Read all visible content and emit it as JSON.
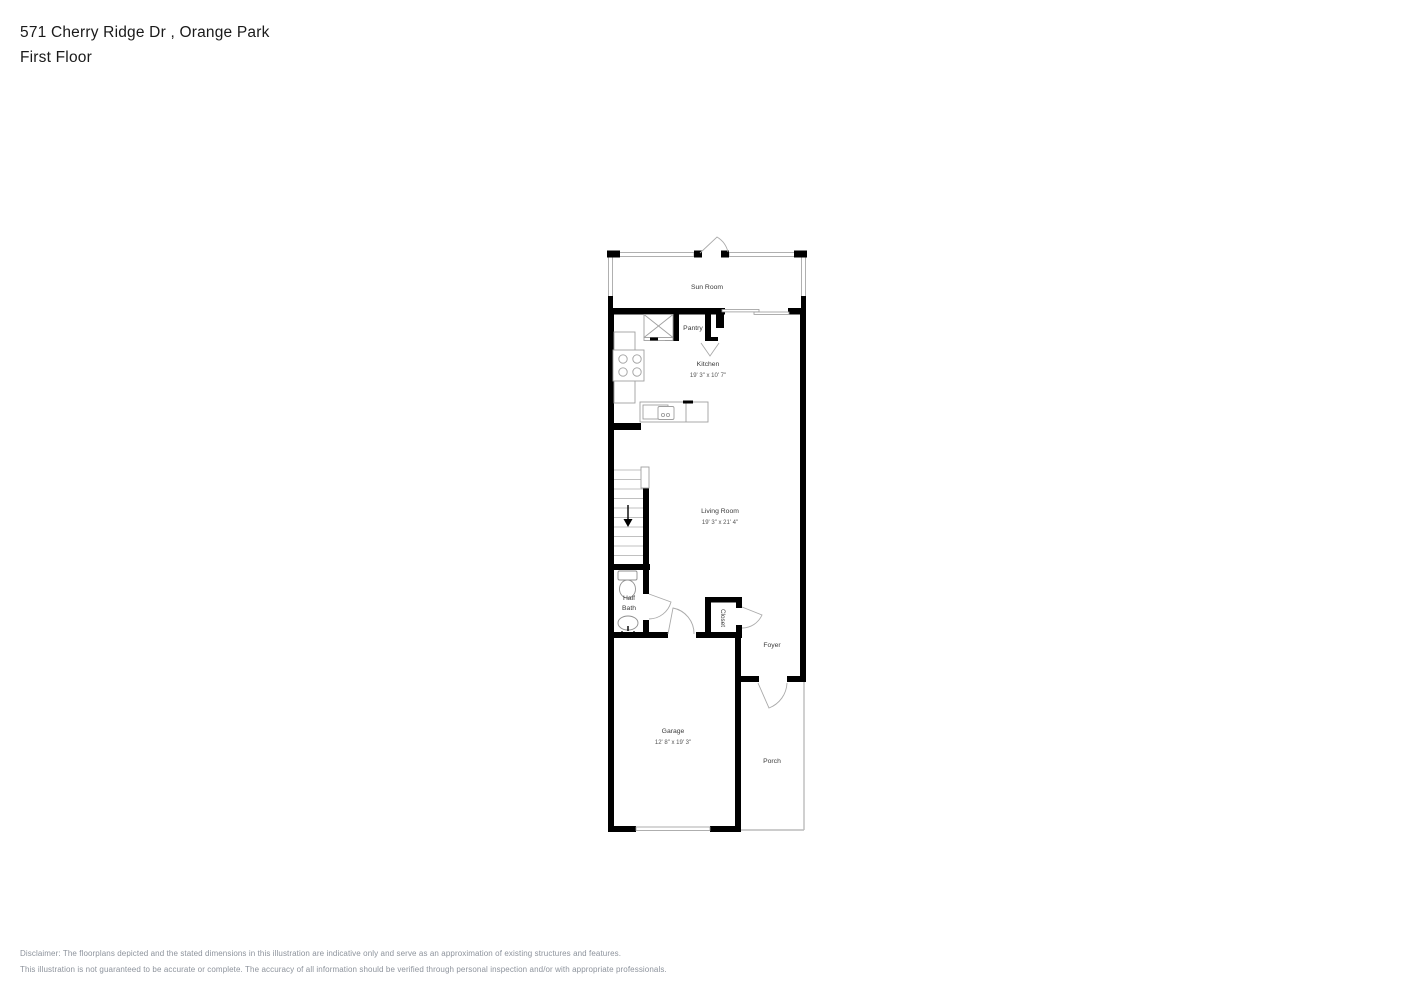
{
  "header": {
    "address": "571 Cherry Ridge Dr , Orange Park",
    "floor": "First Floor"
  },
  "floorplan": {
    "rooms": {
      "sun_room": {
        "label": "Sun Room"
      },
      "pantry": {
        "label": "Pantry"
      },
      "kitchen": {
        "label": "Kitchen",
        "dims": "19' 3\" x 10' 7\""
      },
      "living_room": {
        "label": "Living Room",
        "dims": "19' 3\" x 21' 4\""
      },
      "half_bath": {
        "label_line1": "Half",
        "label_line2": "Bath"
      },
      "closet": {
        "label": "Closet"
      },
      "foyer": {
        "label": "Foyer"
      },
      "garage": {
        "label": "Garage",
        "dims": "12' 8\" x 19' 3\""
      },
      "porch": {
        "label": "Porch"
      }
    },
    "colors": {
      "wall": "#000000",
      "fixture_line": "#9a9a9a",
      "tread_line": "#c0c0c0",
      "label": "#3a3a3a"
    }
  },
  "disclaimer": {
    "line1": "Disclaimer: The floorplans depicted and the stated dimensions in this illustration are indicative only and serve as an approximation of existing structures and features.",
    "line2": "This illustration is not guaranteed to be accurate or complete. The accuracy of all information should be verified through personal inspection and/or with appropriate professionals."
  }
}
